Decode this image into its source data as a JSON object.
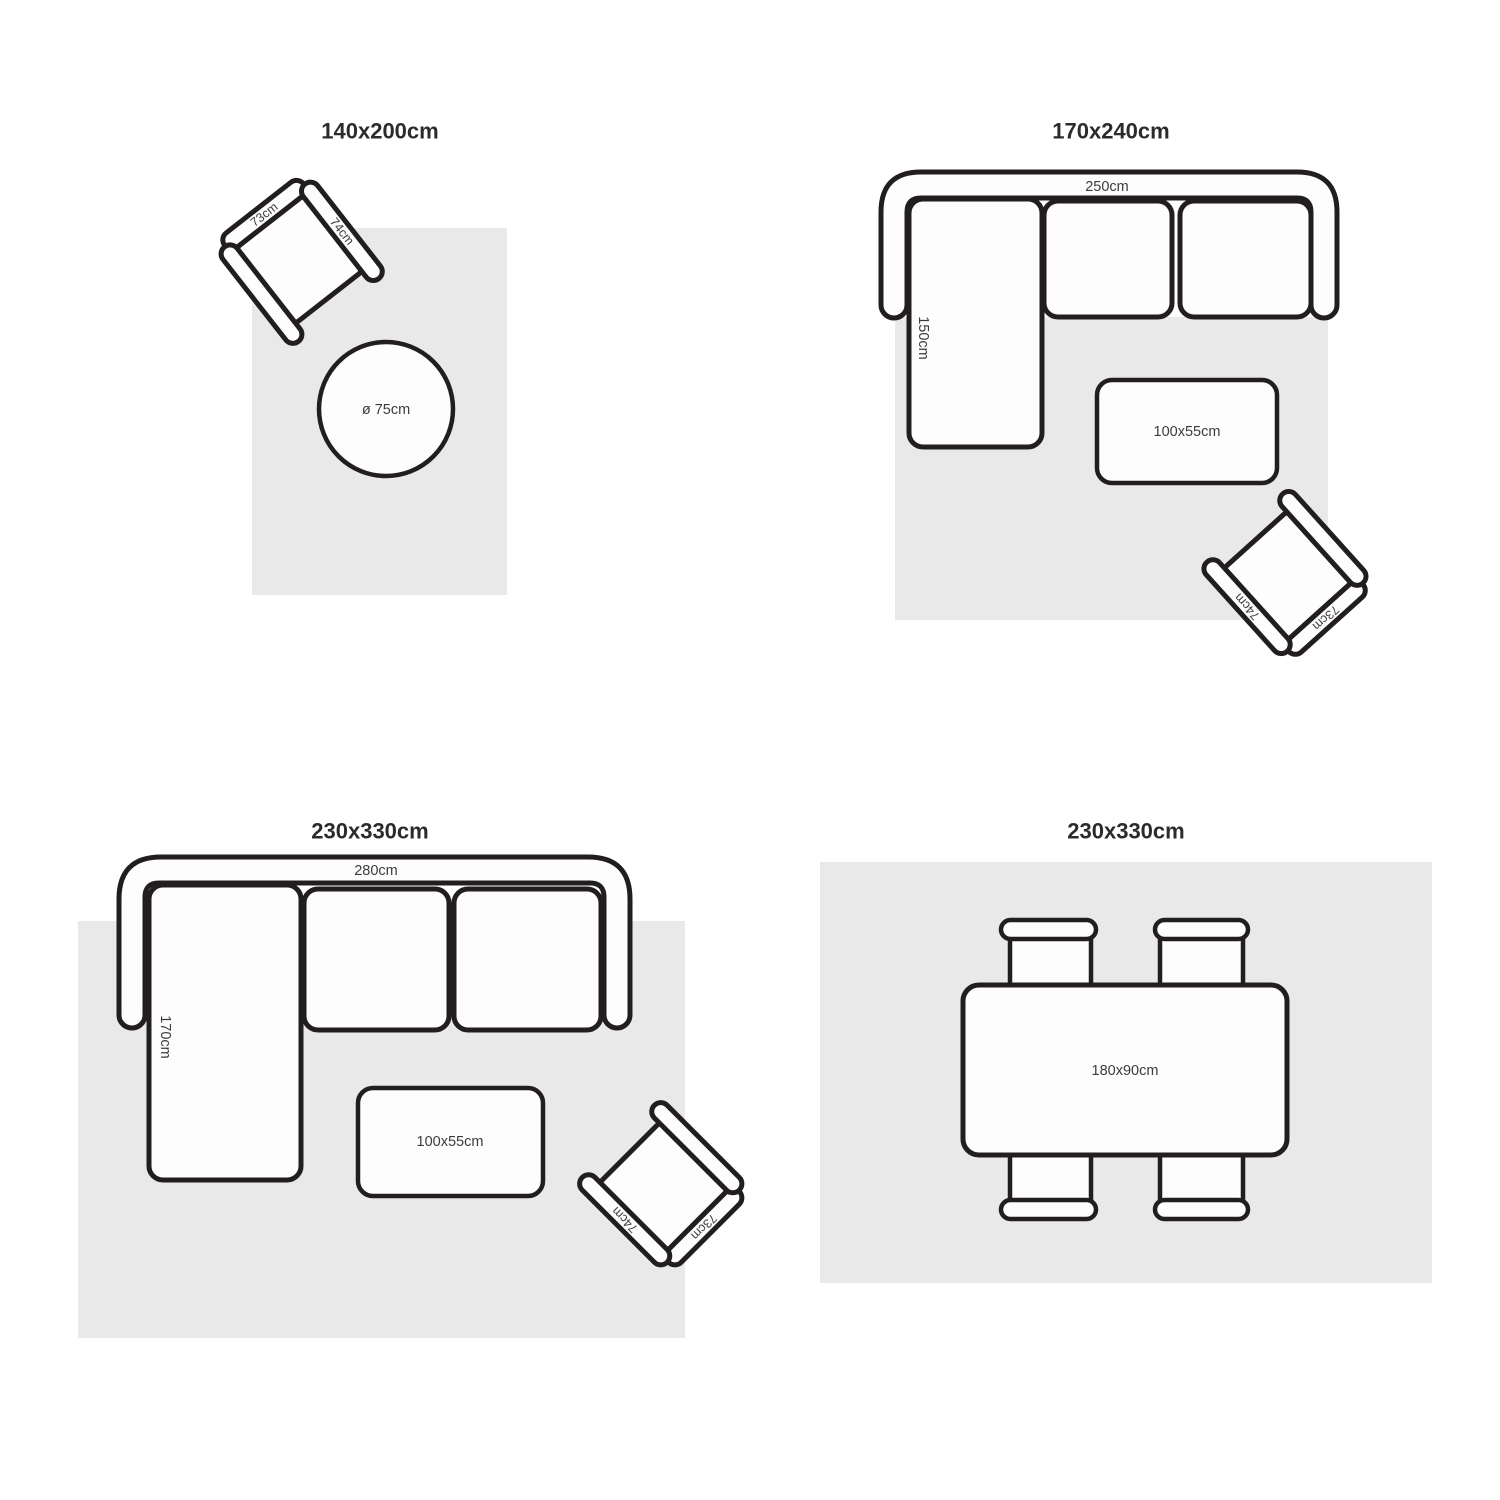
{
  "colors": {
    "outline": "#221e1f",
    "rug": "#e9e9e9",
    "furniture_fill": "#fdfdfd",
    "label_text": "#3c3c3c",
    "title_text": "#2b2b2b"
  },
  "diagrams": [
    {
      "title": "140x200cm",
      "side_table_label": "ø 75cm",
      "armchair": {
        "back": "73cm",
        "arm": "74cm"
      }
    },
    {
      "title": "170x240cm",
      "sofa": {
        "width": "250cm",
        "depth": "150cm"
      },
      "coffee_table": "100x55cm",
      "armchair": {
        "back": "73cm",
        "arm": "74cm"
      }
    },
    {
      "title": "230x330cm",
      "sofa": {
        "width": "280cm",
        "depth": "170cm"
      },
      "coffee_table": "100x55cm",
      "armchair": {
        "back": "73cm",
        "arm": "74cm"
      }
    },
    {
      "title": "230x330cm",
      "dining_table": "180x90cm"
    }
  ]
}
